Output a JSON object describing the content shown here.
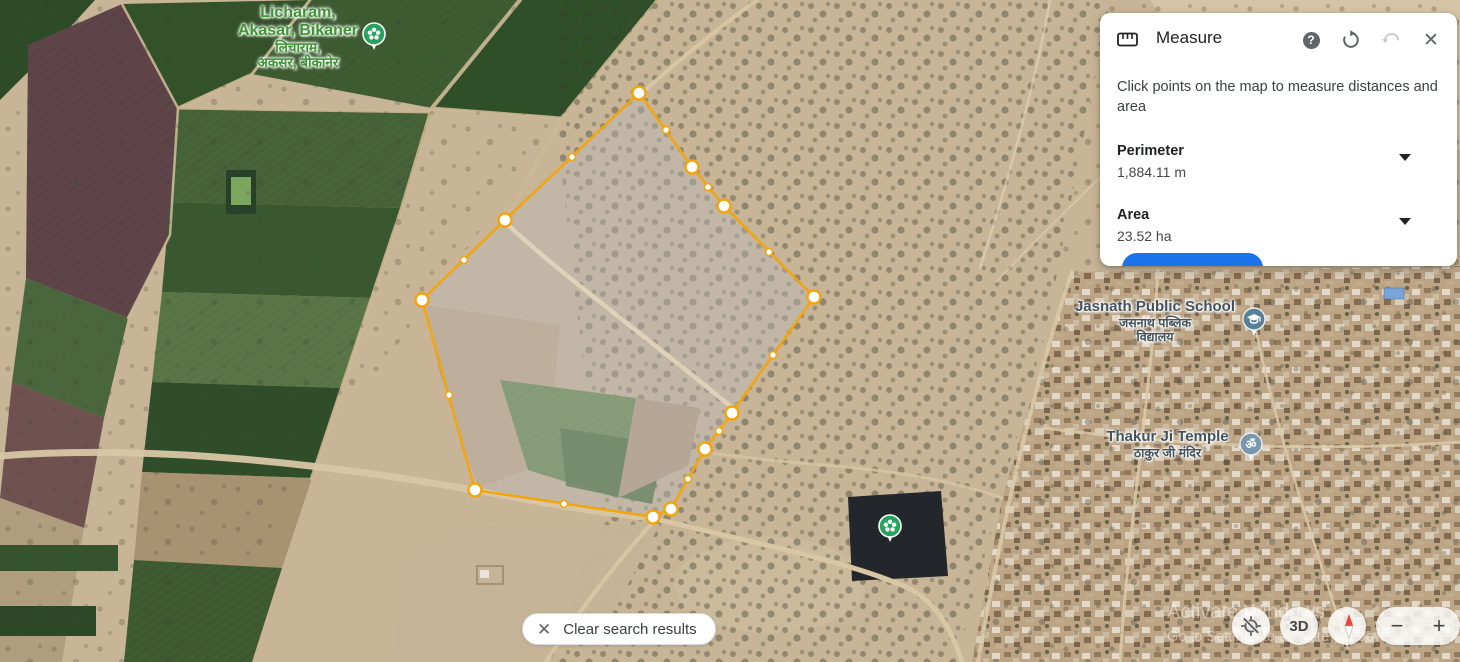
{
  "panel": {
    "title": "Measure",
    "instruction": "Click points on the map to measure distances and area",
    "help_glyph": "?",
    "close_glyph": "✕",
    "perimeter": {
      "label": "Perimeter",
      "value": "1,884.11 m"
    },
    "area": {
      "label": "Area",
      "value": "23.52 ha"
    },
    "accent_color": "#1a73e8"
  },
  "clear_button": {
    "label": "Clear search results"
  },
  "controls": {
    "three_d": "3D",
    "zoom_out": "−",
    "zoom_in": "+"
  },
  "watermark": {
    "line1": "Activate Windows",
    "line2": "Go to Settings to activate Windows."
  },
  "labels": {
    "licharam": {
      "line1": "Licharam,",
      "line2": "Akasar, Bikaner",
      "hindi1": "लिचाराम,",
      "hindi2": "अकसर, बीकानेर"
    },
    "school": {
      "name": "Jasnath Public School",
      "hindi1": "जसनाथ पब्लिक",
      "hindi2": "विद्यालय"
    },
    "temple": {
      "name": "Thakur Ji Temple",
      "hindi": "ठाकुर जी मंदिर"
    }
  },
  "markers": {
    "temple_glyph": "ॐ",
    "park_color": "#27a35d",
    "school_color": "#578196",
    "temple_color": "#7a97ae"
  },
  "measurement": {
    "perimeter_m": 1884.11,
    "area_ha": 23.52,
    "stroke": "#F2A50C",
    "fill": "rgba(255,255,255,0.25)",
    "vertices": [
      [
        639,
        93
      ],
      [
        692,
        167
      ],
      [
        724,
        206
      ],
      [
        814,
        297
      ],
      [
        732,
        413
      ],
      [
        705,
        449
      ],
      [
        671,
        509
      ],
      [
        653,
        517
      ],
      [
        475,
        490
      ],
      [
        422,
        300
      ],
      [
        505,
        220
      ]
    ],
    "midpoints": [
      [
        666,
        130
      ],
      [
        708,
        187
      ],
      [
        769,
        252
      ],
      [
        773,
        355
      ],
      [
        719,
        431
      ],
      [
        688,
        479
      ],
      [
        564,
        504
      ],
      [
        449,
        395
      ],
      [
        464,
        260
      ],
      [
        572,
        157
      ]
    ]
  }
}
